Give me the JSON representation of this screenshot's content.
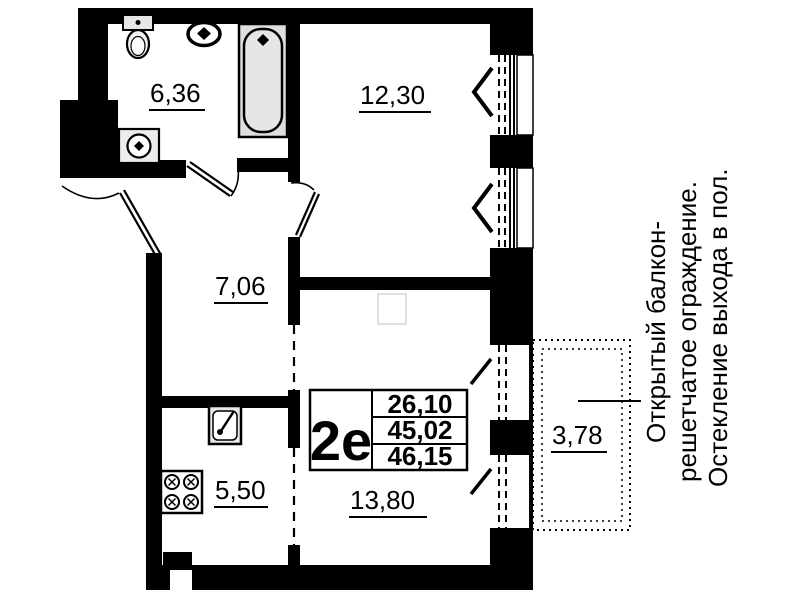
{
  "plan": {
    "unit_label": "2е",
    "areas": {
      "living": "26,10",
      "total": "45,02",
      "total_with_balcony": "46,15"
    },
    "rooms": {
      "bathroom": "6,36",
      "bedroom": "12,30",
      "hall": "7,06",
      "kitchen": "5,50",
      "living_room": "13,80",
      "balcony": "3,78"
    },
    "annotation": {
      "line1": "Открытый балкон-",
      "line2": "решетчатое ограждение.",
      "line3": "Остекление выхода в пол."
    },
    "colors": {
      "wall": "#000000",
      "background": "#ffffff",
      "fixture_fill": "#e0e0e0"
    }
  }
}
